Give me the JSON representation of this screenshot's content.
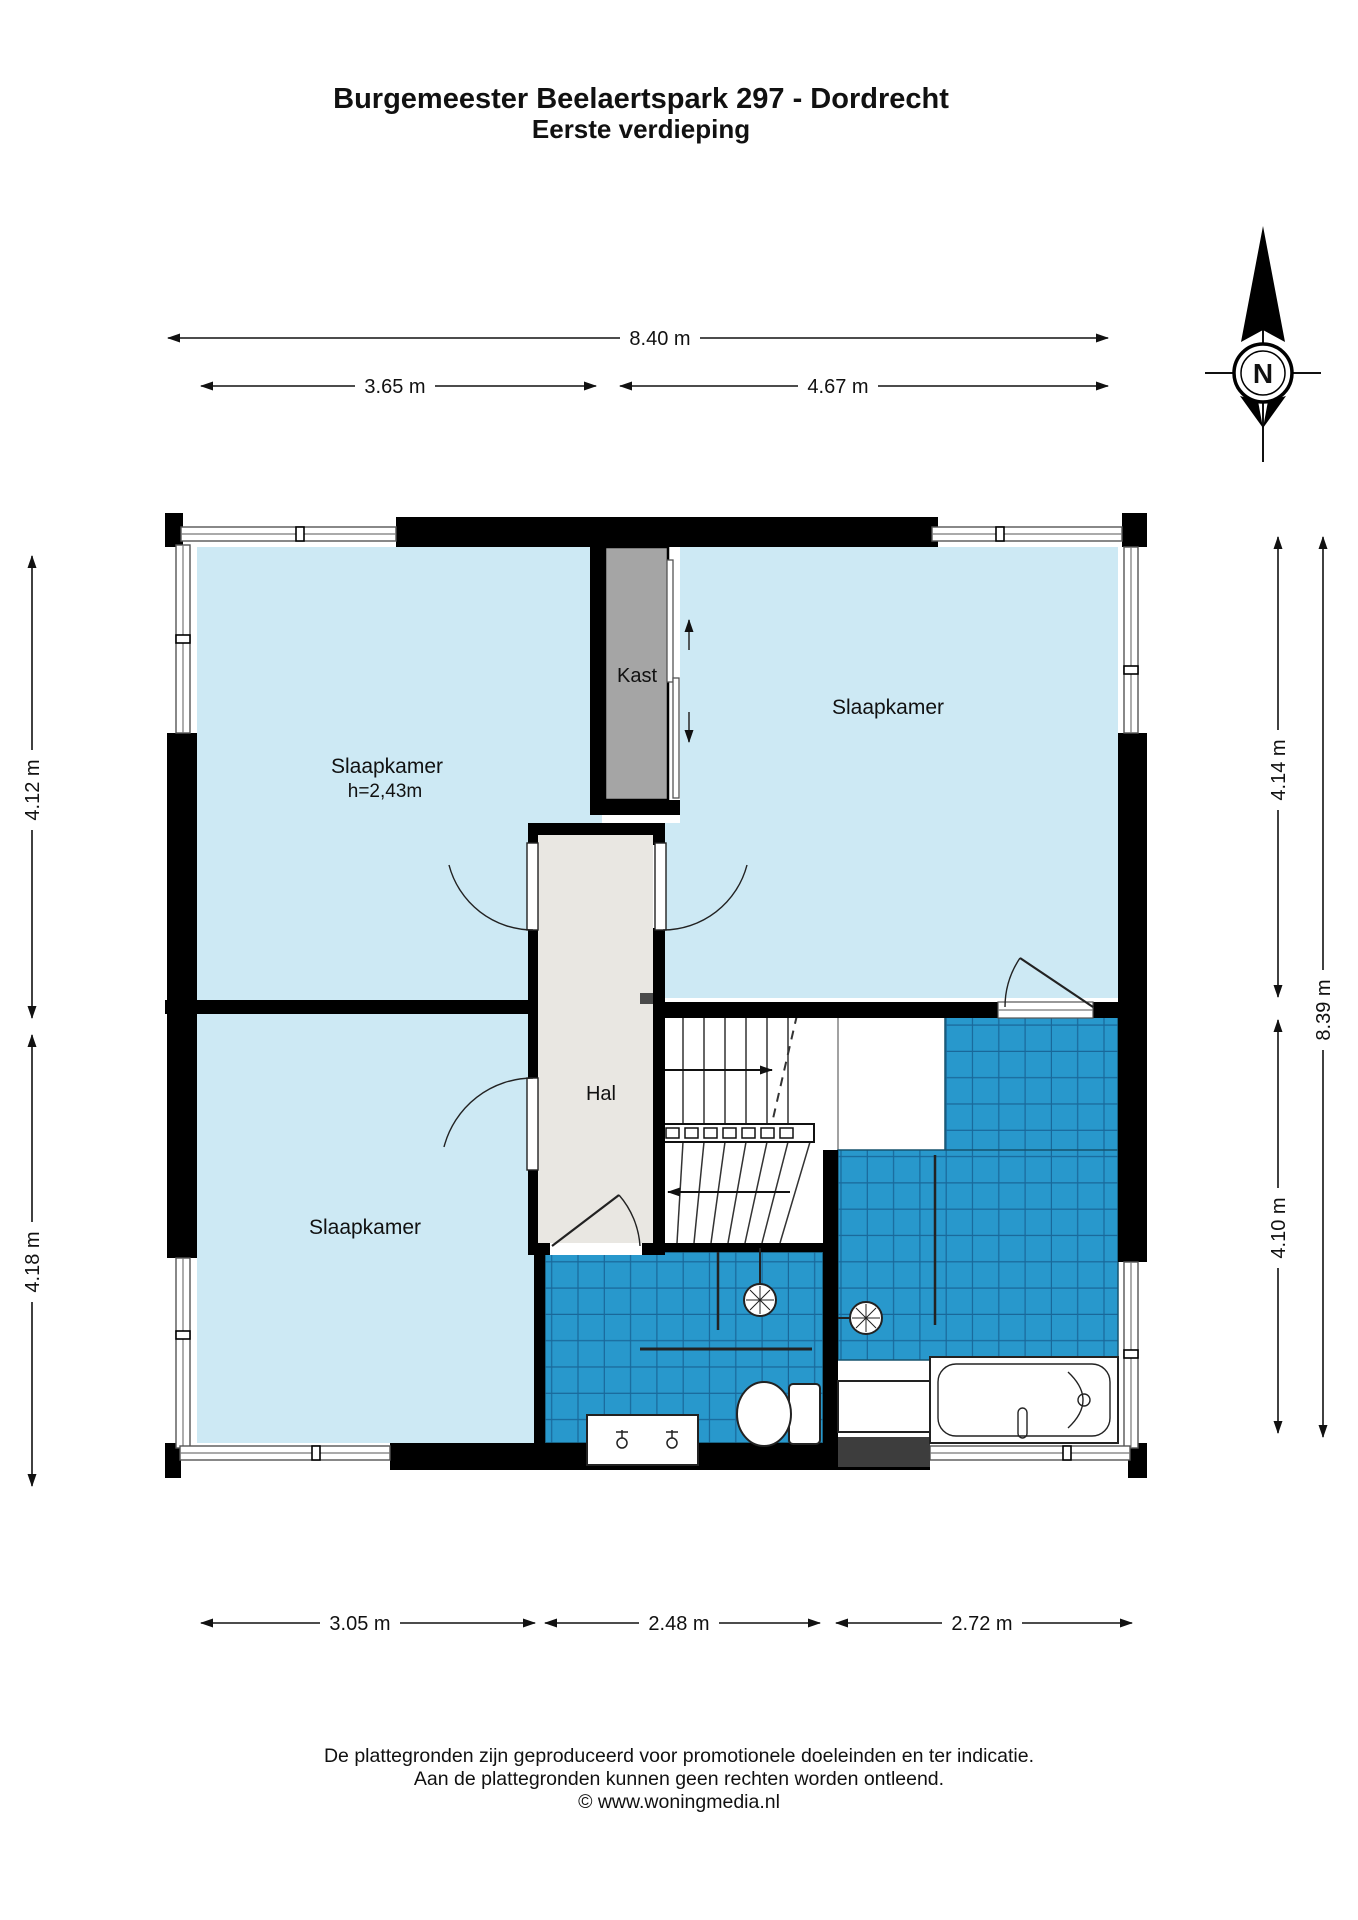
{
  "title": {
    "line1": "Burgemeester Beelaertspark 297 - Dordrecht",
    "line2": "Eerste verdieping"
  },
  "compass": {
    "label": "N"
  },
  "rooms": {
    "bedroom_top_left": "Slaapkamer",
    "bedroom_top_left_height": "h=2,43m",
    "bedroom_top_right": "Slaapkamer",
    "bedroom_bottom_left": "Slaapkamer",
    "hall": "Hal",
    "closet": "Kast"
  },
  "dimensions": {
    "top_total": "8.40 m",
    "top_left": "3.65 m",
    "top_right": "4.67 m",
    "left_upper": "4.12 m",
    "left_lower": "4.18 m",
    "right_upper": "4.14 m",
    "right_total": "8.39 m",
    "right_lower": "4.10 m",
    "bottom_left": "3.05 m",
    "bottom_middle": "2.48 m",
    "bottom_right": "2.72 m"
  },
  "footer": {
    "line1": "De plattegronden zijn geproduceerd voor promotionele doeleinden en ter indicatie.",
    "line2": "Aan de plattegronden kunnen geen rechten worden ontleend.",
    "line3": "© www.woningmedia.nl"
  },
  "colors": {
    "room_blue": "#cde9f4",
    "hall_gray": "#e9e7e2",
    "closet_gray": "#a5a5a5",
    "tile_blue": "#2898cc",
    "tile_grout": "#19689a",
    "wall_black": "#000000"
  }
}
